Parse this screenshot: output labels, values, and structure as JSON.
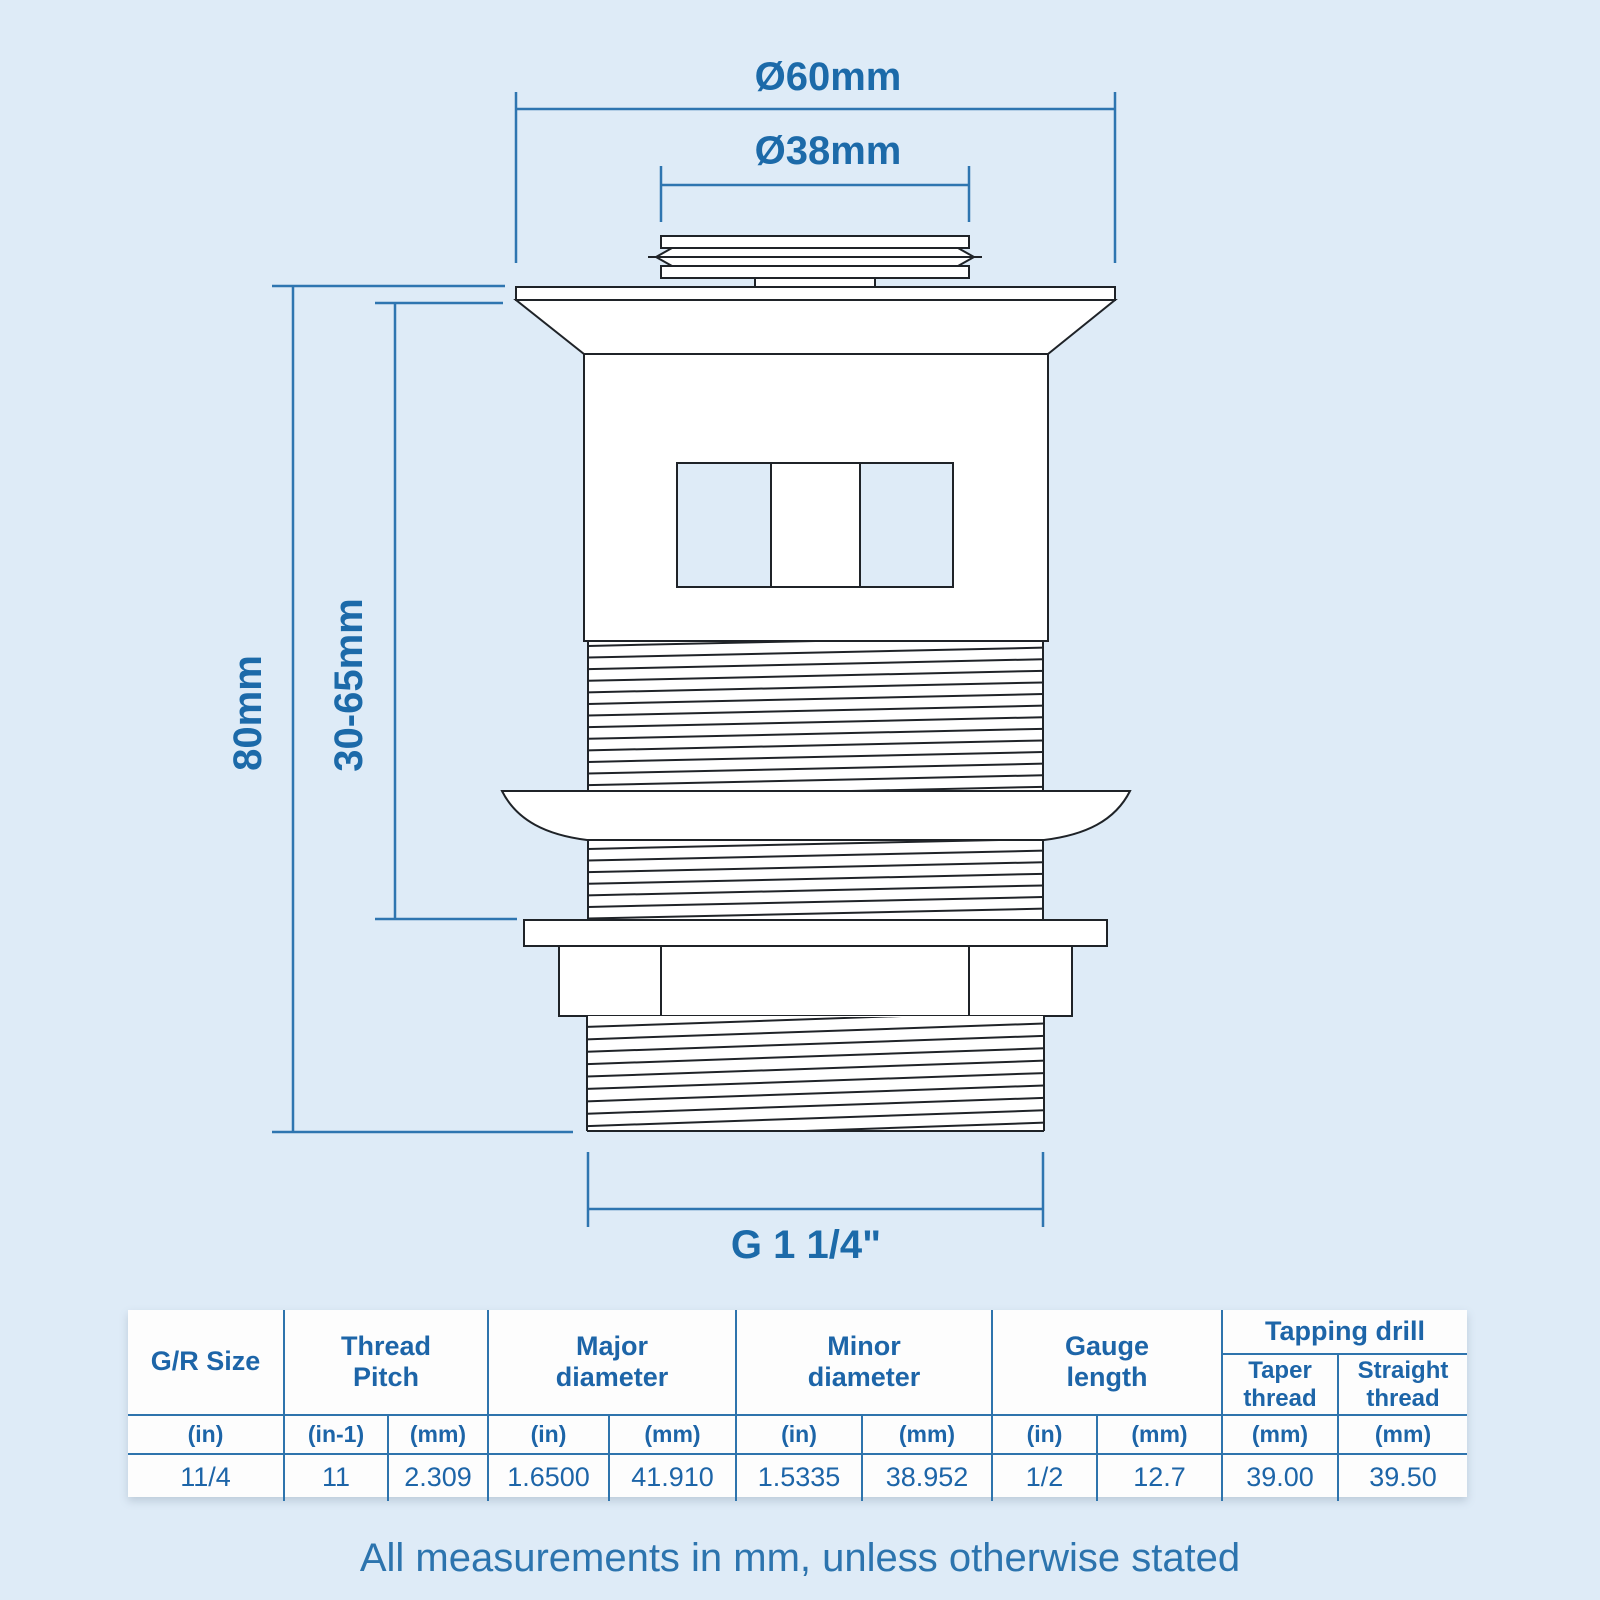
{
  "dimensions": {
    "top_outer_diameter": "Ø60mm",
    "top_inner_diameter": "Ø38mm",
    "total_height": "80mm",
    "adjustable_height": "30-65mm",
    "bottom_thread": "G 1 1/4\""
  },
  "table": {
    "headers": {
      "gr_size": "G/R Size",
      "thread_pitch": "Thread Pitch",
      "major_diameter": "Major diameter",
      "minor_diameter": "Minor diameter",
      "gauge_length": "Gauge length",
      "tapping_drill": "Tapping drill",
      "taper_thread": "Taper thread",
      "straight_thread": "Straight thread"
    },
    "units": [
      "(in)",
      "(in-1)",
      "(mm)",
      "(in)",
      "(mm)",
      "(in)",
      "(mm)",
      "(in)",
      "(mm)",
      "(mm)",
      "(mm)"
    ],
    "values": [
      "11/4",
      "11",
      "2.309",
      "1.6500",
      "41.910",
      "1.5335",
      "38.952",
      "1/2",
      "12.7",
      "39.00",
      "39.50"
    ]
  },
  "footer_note": "All measurements in mm, unless otherwise stated",
  "colors": {
    "background": "#deebf7",
    "line_ink": "#1f2328",
    "dimension_blue": "#2e75b0",
    "text_blue": "#1c6aa9",
    "table_text_blue": "#1d65a8"
  }
}
